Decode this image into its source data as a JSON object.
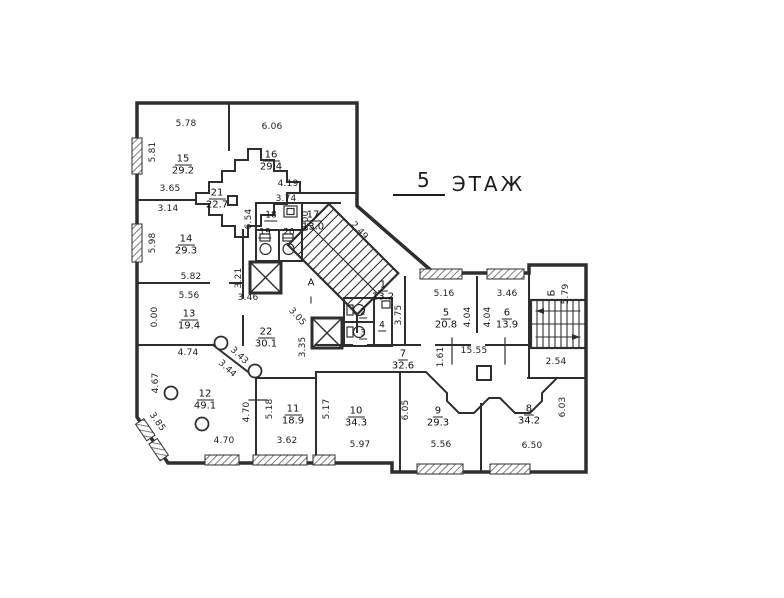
{
  "title": {
    "number": "5",
    "word": "ЭТАЖ"
  },
  "rooms": {
    "r15": {
      "n": "15",
      "a": "29.2"
    },
    "r16": {
      "n": "16",
      "a": "29.4"
    },
    "r21": {
      "n": "21",
      "a": "22.7"
    },
    "r14": {
      "n": "14",
      "a": "29.3"
    },
    "r13": {
      "n": "13",
      "a": "19.4"
    },
    "r12": {
      "n": "12",
      "a": "49.1"
    },
    "r11": {
      "n": "11",
      "a": "18.9"
    },
    "r10": {
      "n": "10",
      "a": "34.3"
    },
    "r9": {
      "n": "9",
      "a": "29.3"
    },
    "r8": {
      "n": "8",
      "a": "34.2"
    },
    "r22": {
      "n": "22",
      "a": "30.1"
    },
    "r17": {
      "n": "17",
      "a": "13.0"
    },
    "r1": {
      "n": "1",
      "a": "13.2"
    },
    "r5": {
      "n": "5",
      "a": "20.8"
    },
    "r6": {
      "n": "6",
      "a": "13.9"
    },
    "r7": {
      "n": "7",
      "a": "32.6"
    }
  },
  "small_rooms": {
    "r18": "18",
    "r19": "19",
    "r20": "20",
    "r2": "2",
    "r3": "3",
    "r4": "4"
  },
  "marks": {
    "row_a": "А",
    "row_i": "I",
    "block_b": "Б"
  },
  "dims": {
    "t15": "5.78",
    "t16": "6.06",
    "b15": "3.65",
    "b16": "4.19",
    "t14": "3.14",
    "t17": "3.74",
    "l15": "5.81",
    "l14": "5.98",
    "l13": "0.00",
    "l12": "4.67",
    "b14": "5.82",
    "t13": "5.56",
    "lift1": "3.46",
    "b13": "4.74",
    "r14": "3.21",
    "wcl": "6.54",
    "wcr": "0.00",
    "hall_h": "3.35",
    "diag_lobby": "3.05",
    "diag_stair": "2.49",
    "diag_a": "3.43",
    "diag_b": "3.44",
    "chamfer": "3.85",
    "w12": "4.70",
    "b12": "4.70",
    "l11": "5.18",
    "b11": "3.62",
    "l10": "5.17",
    "b10": "5.97",
    "r10": "6.05",
    "b9": "5.56",
    "b8": "6.50",
    "r8": "6.03",
    "corr_len": "15.55",
    "corr_w": "1.61",
    "st2_b": "2.54",
    "st2_r": "5.79",
    "t5": "5.16",
    "l5": "3.75",
    "r5": "4.04",
    "l6": "4.04",
    "t6": "3.46"
  },
  "colors": {
    "line": "#2e2e2e",
    "paper": "#ffffff"
  }
}
